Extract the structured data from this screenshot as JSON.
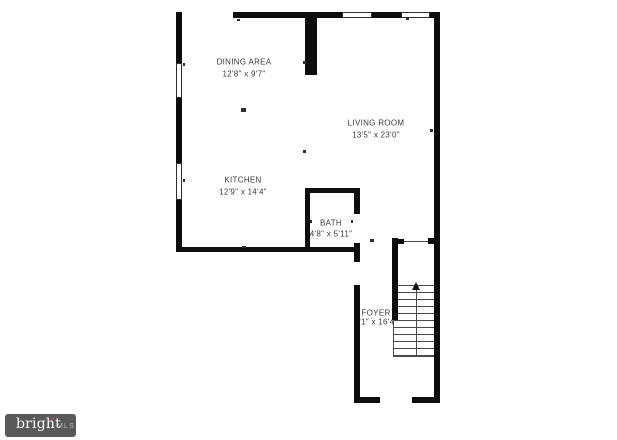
{
  "colors": {
    "background": "#ffffff",
    "wall": "#0d0d0d",
    "line": "#4a4a4a",
    "text": "#3b3b3b",
    "watermark_bg": "#58595b",
    "watermark_text": "#ffffff",
    "watermark_mls": "#b9b9b9",
    "watermark_spark": "#c0453a"
  },
  "rooms": [
    {
      "name": "DINING AREA",
      "dims": "12'8\" x 9'7\"",
      "cx": 244,
      "name_y": 62,
      "dims_y": 74
    },
    {
      "name": "LIVING ROOM",
      "dims": "13'5\" x 23'0\"",
      "cx": 376,
      "name_y": 123,
      "dims_y": 135
    },
    {
      "name": "KITCHEN",
      "dims": "12'9\" x 14'4\"",
      "cx": 243,
      "name_y": 180,
      "dims_y": 192
    },
    {
      "name": "BATH",
      "dims": "4'8\" x 5'11\"",
      "cx": 331,
      "name_y": 223,
      "dims_y": 234
    },
    {
      "name": "FOYER",
      "dims": "3'1\" x 16'4\"",
      "cx": 376,
      "name_y": 313,
      "dims_y": 322
    }
  ],
  "watermark": {
    "brand": "bright",
    "spark": "✦",
    "suffix": "MLS"
  },
  "plan": {
    "walls": [
      {
        "name": "top-wall",
        "rect": [
          233,
          12,
          207,
          6
        ]
      },
      {
        "name": "right-wall",
        "rect": [
          434,
          12,
          6,
          391
        ]
      },
      {
        "name": "left-wall-top",
        "rect": [
          176,
          12,
          6,
          51
        ]
      },
      {
        "name": "left-wall-middle",
        "rect": [
          176,
          98,
          6,
          65
        ]
      },
      {
        "name": "left-wall-bottom",
        "rect": [
          176,
          200,
          6,
          52
        ]
      },
      {
        "name": "kitchen-bottom-wall",
        "rect": [
          176,
          247,
          184,
          5
        ]
      },
      {
        "name": "dining-living-divider",
        "rect": [
          305,
          17,
          12,
          58
        ]
      },
      {
        "name": "bath-left-wall",
        "rect": [
          305,
          188,
          5,
          59
        ]
      },
      {
        "name": "bath-top-wall",
        "rect": [
          305,
          188,
          55,
          5
        ]
      },
      {
        "name": "bath-right-wall-upper",
        "rect": [
          354,
          188,
          6,
          26
        ]
      },
      {
        "name": "bath-right-wall-lower",
        "rect": [
          354,
          243,
          6,
          19
        ]
      },
      {
        "name": "foyer-left-wall",
        "rect": [
          354,
          285,
          6,
          118
        ]
      },
      {
        "name": "bottom-wall-left",
        "rect": [
          354,
          397,
          26,
          6
        ]
      },
      {
        "name": "bottom-wall-right",
        "rect": [
          412,
          397,
          28,
          6
        ]
      },
      {
        "name": "stair-left-wall",
        "rect": [
          392,
          238,
          6,
          82
        ]
      },
      {
        "name": "stair-top-stub-left",
        "rect": [
          398,
          239,
          6,
          5
        ]
      },
      {
        "name": "stair-top-stub-right",
        "rect": [
          428,
          238,
          6,
          6
        ]
      }
    ],
    "windows": [
      {
        "name": "left-window-upper",
        "rect": [
          176,
          63,
          6,
          35
        ]
      },
      {
        "name": "left-window-lower",
        "rect": [
          176,
          163,
          6,
          37
        ]
      },
      {
        "name": "top-window-left",
        "rect": [
          342,
          12,
          30,
          6
        ]
      },
      {
        "name": "top-window-right",
        "rect": [
          401,
          12,
          29,
          6
        ]
      }
    ],
    "thin_lines": [
      {
        "name": "stair-opening-line",
        "rect": [
          403,
          241,
          25,
          1
        ]
      },
      {
        "name": "stair-left-outline",
        "rect": [
          393,
          320,
          1,
          37
        ]
      },
      {
        "name": "stair-bottom-outline",
        "rect": [
          393,
          356,
          41,
          1
        ]
      }
    ],
    "ticks": [
      [
        237,
        19,
        3,
        2
      ],
      [
        303,
        61,
        3,
        3
      ],
      [
        406,
        18,
        3,
        2
      ],
      [
        183,
        63,
        2,
        3
      ],
      [
        183,
        179,
        2,
        3
      ],
      [
        241,
        108,
        5,
        4
      ],
      [
        303,
        150,
        3,
        3
      ],
      [
        430,
        129,
        3,
        3
      ],
      [
        310,
        220,
        2,
        3
      ],
      [
        351,
        220,
        2,
        3
      ],
      [
        370,
        239,
        4,
        3
      ],
      [
        242,
        246,
        4,
        2
      ]
    ],
    "stairs": {
      "tread_x": 394,
      "tread_w": 40,
      "tread_y0": 285,
      "tread_step": 7,
      "tread_count": 11,
      "center_x": 416,
      "arrow_x": 412,
      "arrow_y": 282,
      "direction": "up"
    }
  }
}
